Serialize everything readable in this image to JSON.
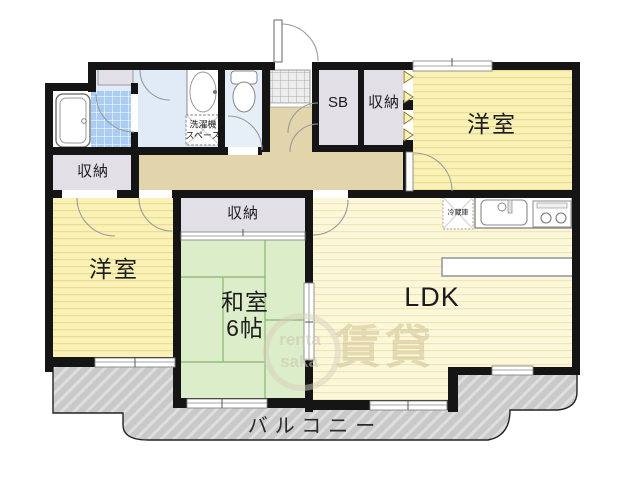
{
  "rooms": {
    "bedroom_right": "洋室",
    "bedroom_left": "洋室",
    "japanese_room": "和室",
    "japanese_room_size": "6帖",
    "ldk": "LDK",
    "balcony": "バルコニー",
    "closet_left": "収納",
    "closet_top": "収納",
    "closet_center": "収納",
    "shoe_box": "SB",
    "washer_space_line1": "洗濯機",
    "washer_space_line2": "スペース",
    "refrigerator": "冷蔵庫"
  },
  "watermark": {
    "kanji": "賃貸",
    "latin_top": "renta",
    "latin_bottom": "saka"
  },
  "icons": {
    "bathtub": "bathtub-icon",
    "bathroom_tile": "bath-tile-icon",
    "washbasin": "washbasin-icon",
    "washer_box": "washing-machine-space-icon",
    "toilet": "toilet-icon",
    "entrance_tile": "entrance-tile-icon",
    "entrance_door": "entrance-door-icon",
    "kitchen_sink": "kitchen-sink-icon",
    "stove": "stove-icon",
    "refrigerator_box": "refrigerator-icon",
    "counter": "kitchen-counter-icon",
    "folding_door_chevrons": "folding-door-icon"
  },
  "colors": {
    "wall": "#151515",
    "bedroom_yellow": "#faf1b6",
    "bedroom_stripe": "#eadc92",
    "ldk_yellow": "#fcf7da",
    "ldk_stripe": "#efe6b4",
    "tatami_green": "#dcedc9",
    "tatami_line": "#93bd79",
    "hallway_tan": "#e2d5ab",
    "washroom_blue": "#e0ebf7",
    "tile_blue": "#a9cdf1",
    "closet_gray": "#e2dfe7",
    "balcony_gray": "#c9c9c9",
    "balcony_hatch": "#dedede"
  }
}
